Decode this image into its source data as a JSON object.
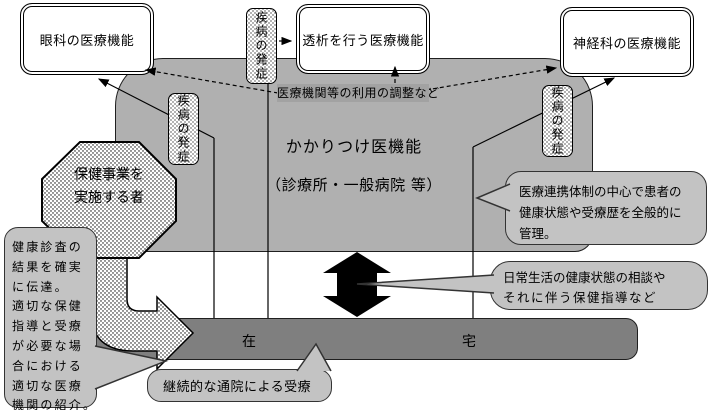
{
  "colors": {
    "primary_care_box": "#b0b0b0",
    "home_bar": "#7f7f7f",
    "callout_fill": "#c3c3c3",
    "coordination_highlight": "#a2a2a2",
    "arrow": "#000000",
    "pattern_fill": "white-with-black-dots"
  },
  "boxes": {
    "ophthalmology": "眼科の医療機能",
    "dialysis": "透析を行う医療機能",
    "neurology": "神経科の医療機能"
  },
  "primary_care": {
    "title": "かかりつけ医機能",
    "subtitle": "（診療所・一般病院 等）"
  },
  "labels": {
    "coordination": "医療機関等の利用の調整など",
    "disease_onset": "疾病の発症"
  },
  "octagon": {
    "lines": [
      "保健事業を",
      "実施する者"
    ]
  },
  "home_bar": {
    "left": "在",
    "right": "宅"
  },
  "callouts": {
    "referral": [
      "健康診査の",
      "結果を確実",
      "に伝達。",
      "適切な保健",
      "指導と受療",
      "が必要な場",
      "合における",
      "適切な医療",
      "機関の紹介。"
    ],
    "management": [
      "医療連携体制の中心で患者の",
      "健康状態や受療歴を全般的に",
      "管理。"
    ],
    "daily": [
      "日常生活の健康状態の相談や",
      "それに伴う保健指導など"
    ],
    "outpatient": "継続的な通院による受療"
  }
}
